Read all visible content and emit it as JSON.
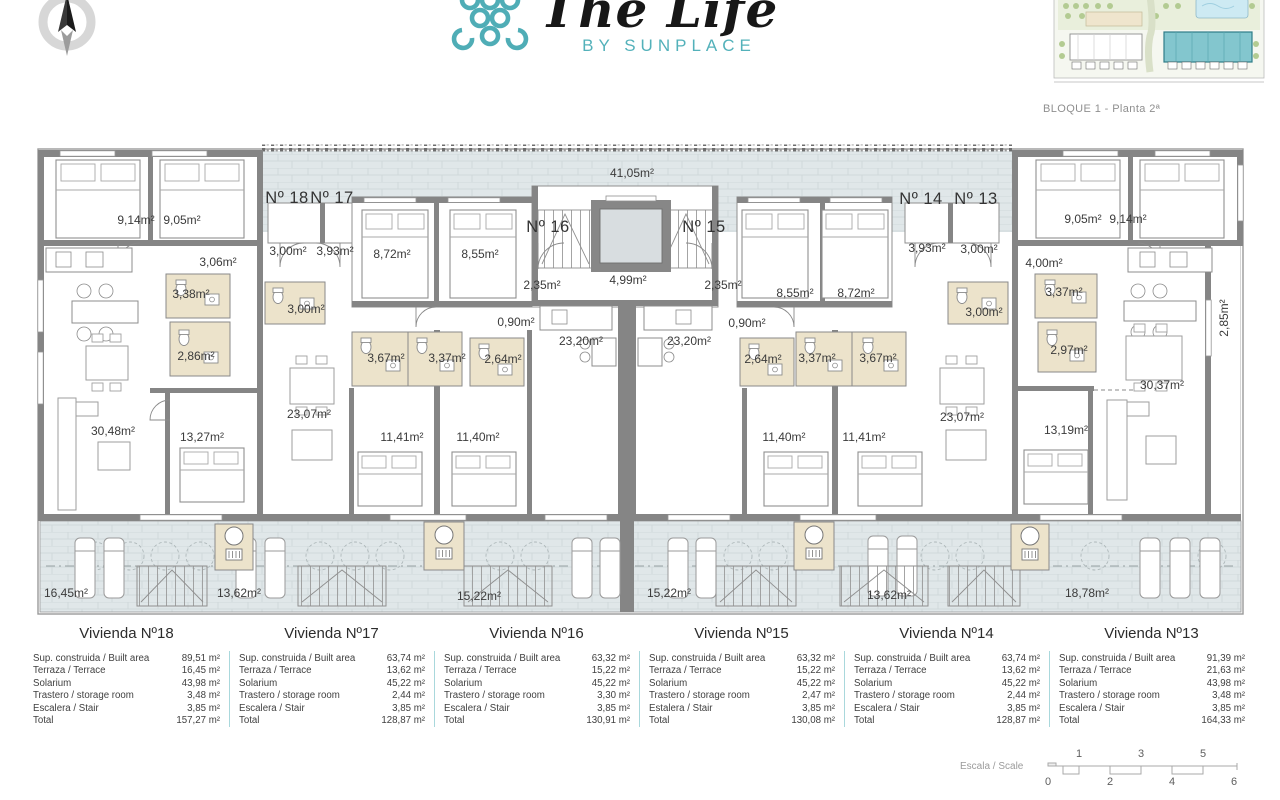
{
  "header": {
    "logo_title": "The Life",
    "logo_subtitle": "BY SUNPLACE",
    "site_caption": "BLOQUE 1 - Planta 2ª",
    "accent_color": "#4FACB5"
  },
  "plan": {
    "unit_labels": [
      {
        "text": "Nº 18",
        "x": 287,
        "y": 203
      },
      {
        "text": "Nº 17",
        "x": 332,
        "y": 203
      },
      {
        "text": "Nº 16",
        "x": 548,
        "y": 232
      },
      {
        "text": "Nº 15",
        "x": 704,
        "y": 232
      },
      {
        "text": "Nº 14",
        "x": 921,
        "y": 204
      },
      {
        "text": "Nº 13",
        "x": 976,
        "y": 204
      }
    ],
    "area_labels": [
      {
        "text": "41,05m²",
        "x": 632,
        "y": 177
      },
      {
        "text": "9,14m²",
        "x": 136,
        "y": 224
      },
      {
        "text": "9,05m²",
        "x": 182,
        "y": 224
      },
      {
        "text": "3,06m²",
        "x": 218,
        "y": 266
      },
      {
        "text": "3,38m²",
        "x": 191,
        "y": 298
      },
      {
        "text": "2,86m²",
        "x": 196,
        "y": 360
      },
      {
        "text": "3,00m²",
        "x": 288,
        "y": 255
      },
      {
        "text": "3,93m²",
        "x": 335,
        "y": 255
      },
      {
        "text": "3,00m²",
        "x": 306,
        "y": 313
      },
      {
        "text": "8,72m²",
        "x": 392,
        "y": 258
      },
      {
        "text": "8,55m²",
        "x": 480,
        "y": 258
      },
      {
        "text": "2,35m²",
        "x": 542,
        "y": 289
      },
      {
        "text": "0,90m²",
        "x": 516,
        "y": 326
      },
      {
        "text": "3,67m²",
        "x": 386,
        "y": 362
      },
      {
        "text": "3,37m²",
        "x": 447,
        "y": 362
      },
      {
        "text": "2,64m²",
        "x": 503,
        "y": 363
      },
      {
        "text": "23,20m²",
        "x": 581,
        "y": 345
      },
      {
        "text": "4,99m²",
        "x": 628,
        "y": 284
      },
      {
        "text": "2,35m²",
        "x": 723,
        "y": 289
      },
      {
        "text": "8,55m²",
        "x": 795,
        "y": 297
      },
      {
        "text": "8,72m²",
        "x": 856,
        "y": 297
      },
      {
        "text": "0,90m²",
        "x": 747,
        "y": 327
      },
      {
        "text": "2,64m²",
        "x": 763,
        "y": 363
      },
      {
        "text": "3,37m²",
        "x": 817,
        "y": 362
      },
      {
        "text": "3,67m²",
        "x": 878,
        "y": 362
      },
      {
        "text": "23,20m²",
        "x": 689,
        "y": 345
      },
      {
        "text": "3,93m²",
        "x": 927,
        "y": 252
      },
      {
        "text": "3,00m²",
        "x": 979,
        "y": 253
      },
      {
        "text": "4,00m²",
        "x": 1044,
        "y": 267
      },
      {
        "text": "3,00m²",
        "x": 984,
        "y": 316
      },
      {
        "text": "3,37m²",
        "x": 1064,
        "y": 296
      },
      {
        "text": "2,97m²",
        "x": 1069,
        "y": 354
      },
      {
        "text": "9,05m²",
        "x": 1083,
        "y": 223
      },
      {
        "text": "9,14m²",
        "x": 1128,
        "y": 223
      },
      {
        "text": "30,48m²",
        "x": 113,
        "y": 435
      },
      {
        "text": "13,27m²",
        "x": 202,
        "y": 441
      },
      {
        "text": "23,07m²",
        "x": 309,
        "y": 418
      },
      {
        "text": "11,41m²",
        "x": 402,
        "y": 441
      },
      {
        "text": "11,40m²",
        "x": 478,
        "y": 441
      },
      {
        "text": "11,40m²",
        "x": 784,
        "y": 441
      },
      {
        "text": "11,41m²",
        "x": 864,
        "y": 441
      },
      {
        "text": "23,07m²",
        "x": 962,
        "y": 421
      },
      {
        "text": "13,19m²",
        "x": 1066,
        "y": 434
      },
      {
        "text": "30,37m²",
        "x": 1162,
        "y": 389
      },
      {
        "text": "2,85m²",
        "x": 1228,
        "y": 318,
        "rot": -90
      },
      {
        "text": "16,45m²",
        "x": 66,
        "y": 597
      },
      {
        "text": "13,62m²",
        "x": 239,
        "y": 597
      },
      {
        "text": "15,22m²",
        "x": 479,
        "y": 600
      },
      {
        "text": "15,22m²",
        "x": 669,
        "y": 597
      },
      {
        "text": "13,62m²",
        "x": 889,
        "y": 599
      },
      {
        "text": "18,78m²",
        "x": 1087,
        "y": 597
      }
    ]
  },
  "units": [
    {
      "title": "Vivienda Nº18",
      "rows": [
        [
          "Sup. construida / Built area",
          "89,51 m²"
        ],
        [
          "Terraza / Terrace",
          "16,45 m²"
        ],
        [
          "Solarium",
          "43,98 m²"
        ],
        [
          "Trastero / storage room",
          "3,48 m²"
        ],
        [
          "Escalera / Stair",
          "3,85 m²"
        ],
        [
          "Total",
          "157,27 m²"
        ]
      ]
    },
    {
      "title": "Vivienda Nº17",
      "rows": [
        [
          "Sup. construida / Built area",
          "63,74 m²"
        ],
        [
          "Terraza / Terrace",
          "13,62 m²"
        ],
        [
          "Solarium",
          "45,22 m²"
        ],
        [
          "Trastero / storage room",
          "2,44 m²"
        ],
        [
          "Escalera / Stair",
          "3,85 m²"
        ],
        [
          "Total",
          "128,87 m²"
        ]
      ]
    },
    {
      "title": "Vivienda Nº16",
      "rows": [
        [
          "Sup. construida / Built area",
          "63,32 m²"
        ],
        [
          "Terraza / Terrace",
          "15,22 m²"
        ],
        [
          "Solarium",
          "45,22 m²"
        ],
        [
          "Trastero / storage room",
          "3,30 m²"
        ],
        [
          "Escalera / Stair",
          "3,85 m²"
        ],
        [
          "Total",
          "130,91 m²"
        ]
      ]
    },
    {
      "title": "Vivienda Nº15",
      "rows": [
        [
          "Sup. construida / Built area",
          "63,32 m²"
        ],
        [
          "Terraza / Terrace",
          "15,22 m²"
        ],
        [
          "Solarium",
          "45,22 m²"
        ],
        [
          "Trastero / storage room",
          "2,47 m²"
        ],
        [
          "Estalera / Stair",
          "3,85 m²"
        ],
        [
          "Total",
          "130,08 m²"
        ]
      ]
    },
    {
      "title": "Vivienda Nº14",
      "rows": [
        [
          "Sup. construida / Built area",
          "63,74 m²"
        ],
        [
          "Terraza / Terrace",
          "13,62 m²"
        ],
        [
          "Solarium",
          "45,22 m²"
        ],
        [
          "Trastero / storage room",
          "2,44 m²"
        ],
        [
          "Escalera / Stair",
          "3,85 m²"
        ],
        [
          "Total",
          "128,87 m²"
        ]
      ]
    },
    {
      "title": "Vivienda Nº13",
      "rows": [
        [
          "Sup. construida / Built area",
          "91,39 m²"
        ],
        [
          "Terraza / Terrace",
          "21,63 m²"
        ],
        [
          "Solarium",
          "43,98 m²"
        ],
        [
          "Trastero / storage room",
          "3,48 m²"
        ],
        [
          "Escalera / Stair",
          "3,85 m²"
        ],
        [
          "Total",
          "164,33 m²"
        ]
      ]
    }
  ],
  "scale": {
    "label": "Escala / Scale",
    "top_ticks": [
      "1",
      "3",
      "5"
    ],
    "bottom_ticks": [
      "0",
      "2",
      "4",
      "6"
    ]
  }
}
